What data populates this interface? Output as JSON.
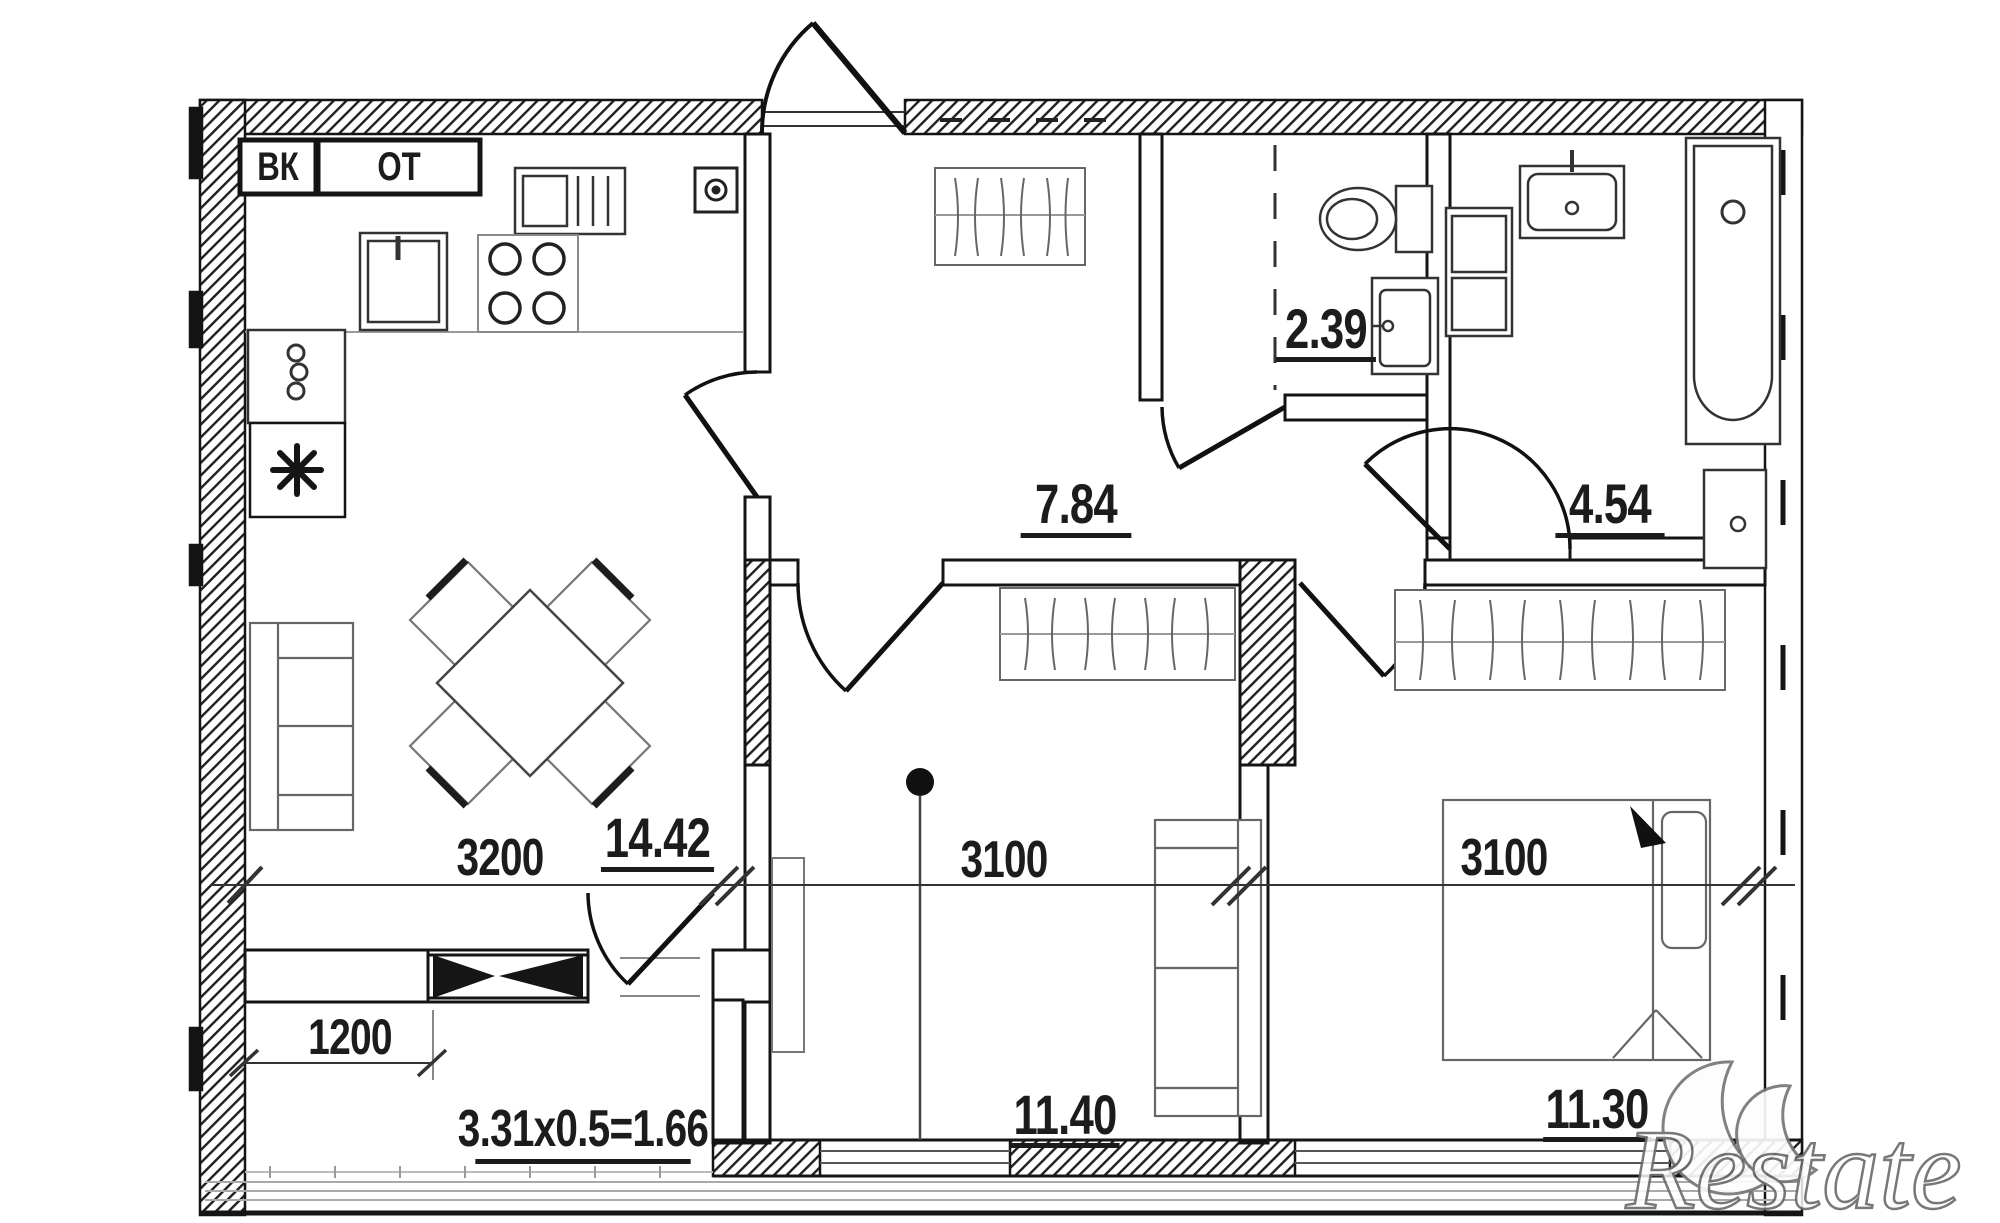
{
  "shafts": {
    "ventilation": "ВК",
    "heating": "ОТ"
  },
  "rooms": {
    "hallway": "7.84",
    "wc": "2.39",
    "bathroom": "4.54",
    "kitchen_living": "14.42",
    "bedroom_middle": "11.40",
    "bedroom_right": "11.30"
  },
  "dimensions": {
    "kitchen_width": "3200",
    "bedroom_middle_width": "3100",
    "bedroom_right_width": "3100",
    "balcony_width": "1200",
    "balcony_area_formula": "3.31x0.5=1.66"
  },
  "watermark": {
    "text": "Restate"
  },
  "colors": {
    "wall_line": "#161616",
    "furniture_line": "#5a5a5a",
    "light_line": "#a9a9a9",
    "text": "#1c1c1c",
    "watermark_outline": "#6d6d6d"
  }
}
